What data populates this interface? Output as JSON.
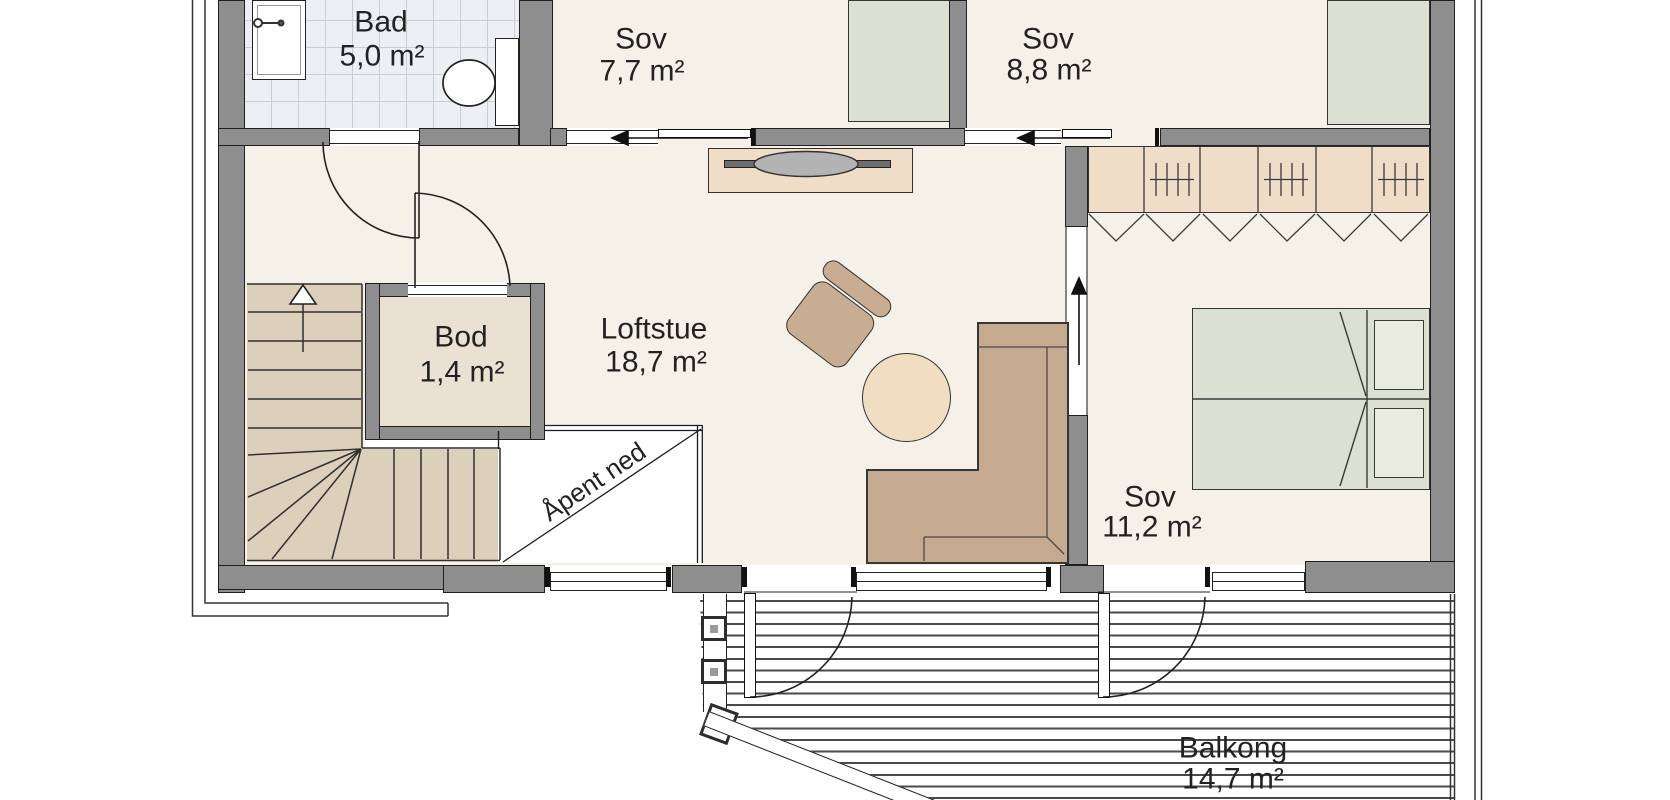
{
  "rooms": {
    "bad": {
      "name": "Bad",
      "area": "5,0 m²"
    },
    "sov_77": {
      "name": "Sov",
      "area": "7,7 m²"
    },
    "sov_88": {
      "name": "Sov",
      "area": "8,8 m²"
    },
    "bod": {
      "name": "Bod",
      "area": "1,4 m²"
    },
    "loftstue": {
      "name": "Loftstue",
      "area": "18,7 m²"
    },
    "sov_112": {
      "name": "Sov",
      "area": "11,2 m²"
    },
    "balkong": {
      "name": "Balkong",
      "area": "14,7 m²"
    }
  },
  "annotations": {
    "open_below": "Åpent ned"
  },
  "colors": {
    "wall": "#8e8e8e",
    "outline": "#1f1f1f",
    "floor": "#f5f1e9",
    "tile_floor": "#edeff4",
    "wood": "#ddd0bb",
    "storage_floor": "#ebe1d2",
    "furniture_tan": "#c5aa90",
    "furniture_light": "#efddc7",
    "bed": "#dce0d2",
    "table": "#f0ddc2",
    "deck_line": "#4a4a4a",
    "text": "#222222"
  }
}
